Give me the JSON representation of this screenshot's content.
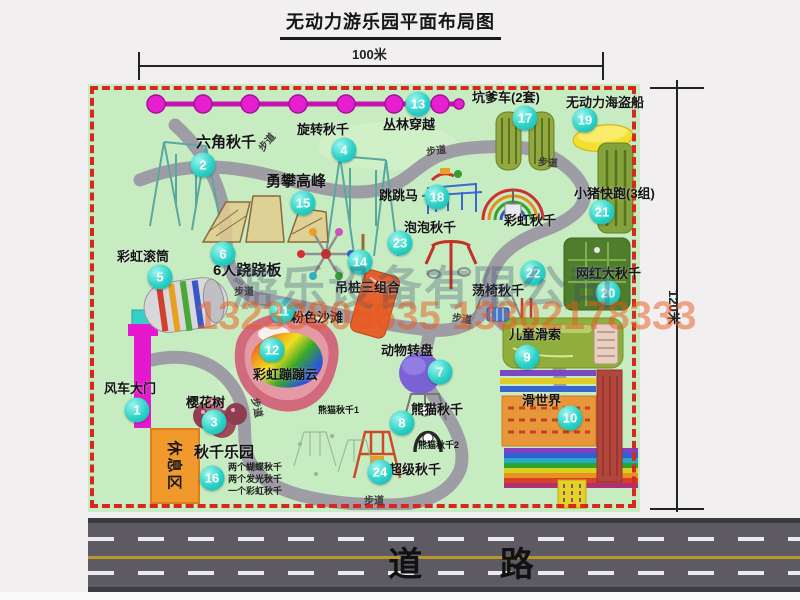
{
  "title": "无动力游乐园平面布局图",
  "dimensions": {
    "horizontal": "100米",
    "vertical": "120米"
  },
  "road": {
    "label": "道 路"
  },
  "watermark": {
    "company": "游乐设备有限公司",
    "phone": "13233805635 13302178333"
  },
  "map": {
    "items": [
      {
        "num": "1",
        "label": "风车大门"
      },
      {
        "num": "2",
        "label": "六角秋千"
      },
      {
        "num": "3",
        "label": "樱花树"
      },
      {
        "num": "4",
        "label": "旋转秋千"
      },
      {
        "num": "5",
        "label": "彩虹滚筒"
      },
      {
        "num": "6",
        "label": "6人跷跷板"
      },
      {
        "num": "7",
        "label": "动物转盘"
      },
      {
        "num": "8",
        "label": "熊猫秋千"
      },
      {
        "num": "9",
        "label": "儿童滑索"
      },
      {
        "num": "10",
        "label": "滑世界"
      },
      {
        "num": "11",
        "label": "粉色沙滩"
      },
      {
        "num": "12",
        "label": "彩虹蹦蹦云"
      },
      {
        "num": "13",
        "label": "丛林穿越"
      },
      {
        "num": "14",
        "label": "吊桩三组合"
      },
      {
        "num": "15",
        "label": "勇攀高峰"
      },
      {
        "num": "16",
        "label": "秋千乐园"
      },
      {
        "num": "17",
        "label": "坑爹车(2套)"
      },
      {
        "num": "18",
        "label": "跳跳马"
      },
      {
        "num": "19",
        "label": "无动力海盗船"
      },
      {
        "num": "20",
        "label": "网红大秋千"
      },
      {
        "num": "21",
        "label": "小猪快跑(3组)"
      },
      {
        "num": "22",
        "label": "荡椅秋千"
      },
      {
        "num": "23",
        "label": "泡泡秋千"
      },
      {
        "num": "24",
        "label": "超级秋千"
      }
    ],
    "extra_labels": {
      "rainbow_swing": "彩虹秋千",
      "panda_swing_1": "熊猫秋千1",
      "panda_swing_2": "熊猫秋千2",
      "rest_area": "休息区",
      "path": "步道"
    },
    "swing_park_notes": [
      "两个蝴蝶秋千",
      "两个发光秋千",
      "一个彩虹秋千"
    ],
    "colors": {
      "map_green": "#c7ecc2",
      "border_red": "#d8281e",
      "path_gray": "#9e9da6",
      "badge_teal": "#2bd2c7",
      "zipline_magenta": "#e61fd0",
      "road_gray": "#5d5a64",
      "rest_area_orange": "#f2992e"
    }
  }
}
